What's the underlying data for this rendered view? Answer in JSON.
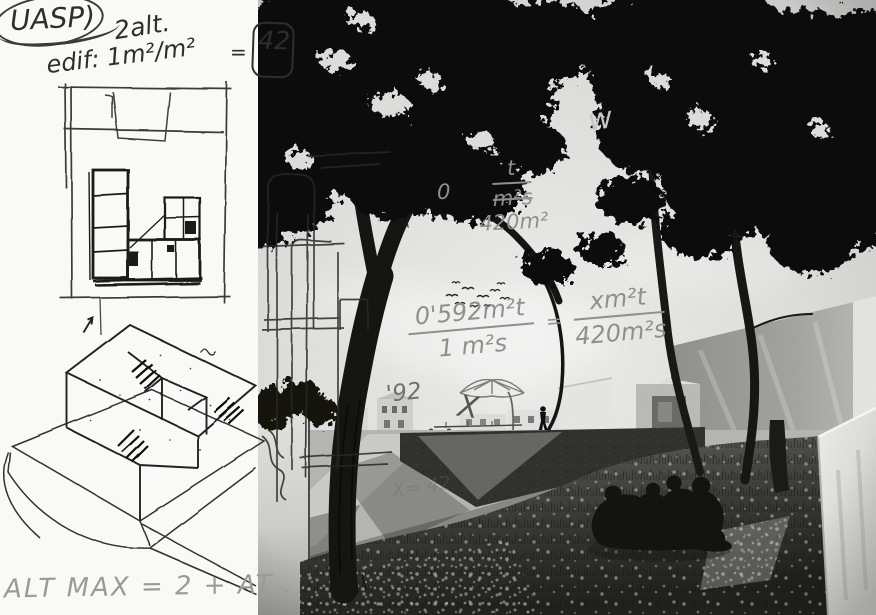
{
  "colors": {
    "ink": "#2e2e2c",
    "pencil": "#8f8f8d",
    "paper": "#f9f9f7",
    "sky": "#e7e7e5",
    "foliage": "#0d0d0b",
    "concrete_dark": "#343432",
    "concrete_light": "#ececea"
  },
  "sketch_page": {
    "label_uasp": "UASP)",
    "label_2alt": "2alt.",
    "label_edif": "edif: 1m²/m²",
    "equals": "=",
    "boxed_value": "42",
    "alt_max": "ALT MAX = 2 + AT ."
  },
  "photo_annotations": {
    "zero": "0",
    "frac_top": {
      "num": "t",
      "den_struck": "m²s",
      "den": "420m²"
    },
    "equation": {
      "lhs_num": "0'592m²t",
      "lhs_den": "1 m²s",
      "equals": "=",
      "rhs_num": "xm²t",
      "rhs_den": "420m²s"
    },
    "year": "'92",
    "x_mark": "X",
    "w_mark": "w",
    "ramp_note": "X= 42"
  }
}
